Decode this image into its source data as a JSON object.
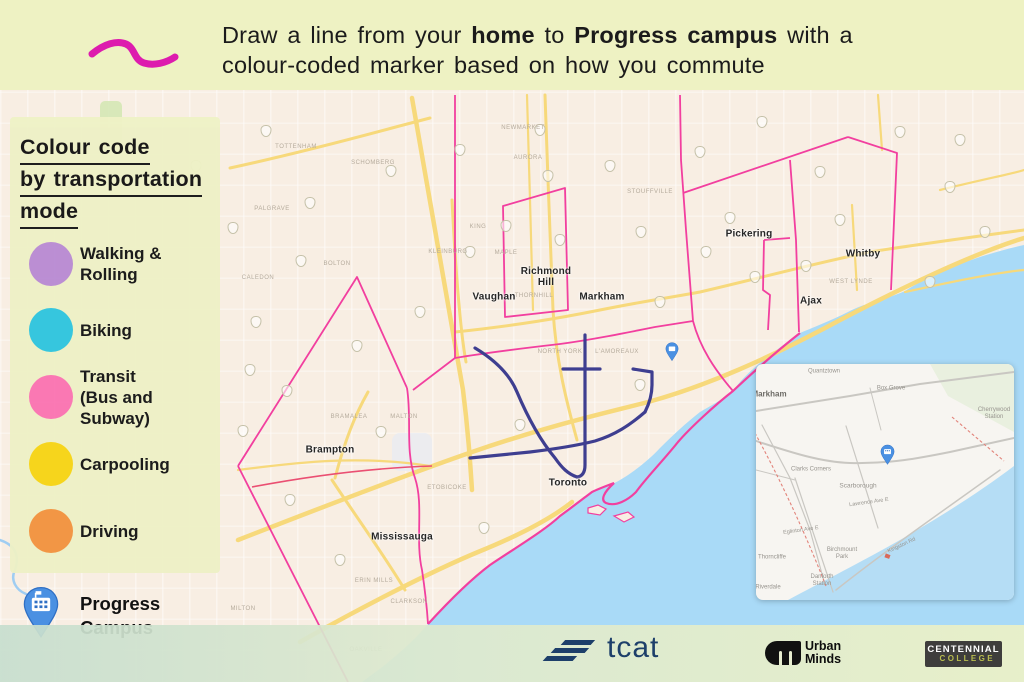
{
  "colors": {
    "header_bg": "#eef2c3",
    "accent_squiggle": "#dd1cae",
    "panel_bg": "#eef1c6",
    "land": "#f8eee3",
    "water": "#a9daf7",
    "highway": "#f7d97b",
    "boundary_pink": "#f23f9f",
    "boundary_red": "#ea4f72",
    "subway_navy": "#3e3e90",
    "pin_blue": "#4a90e2",
    "pin_dark": "#2f6fc4",
    "tcat_navy": "#1d3f6a",
    "um_black": "#111111",
    "centennial_bg": "#3e3d3c",
    "centennial_college": "#b9bd4f",
    "text_dark": "#1b1b1b"
  },
  "header": {
    "segments": [
      {
        "text": "Draw a line from your ",
        "bold": false
      },
      {
        "text": "home",
        "bold": true
      },
      {
        "text": " to ",
        "bold": false
      },
      {
        "text": "Progress campus",
        "bold": true
      },
      {
        "text": " with a",
        "bold": false
      }
    ],
    "line2": "colour-coded marker based on how you commute"
  },
  "legend": {
    "title_lines": [
      "Colour code",
      "by transportation",
      "mode"
    ],
    "items": [
      {
        "label_lines": [
          "Walking &",
          "Rolling"
        ],
        "color": "#b98bd3"
      },
      {
        "label_lines": [
          "Biking"
        ],
        "color": "#2fc5de"
      },
      {
        "label_lines": [
          "Transit",
          "(Bus and Subway)"
        ],
        "color": "#fb74b2"
      },
      {
        "label_lines": [
          "Carpooling"
        ],
        "color": "#f6d414"
      },
      {
        "label_lines": [
          "Driving"
        ],
        "color": "#f2933f"
      }
    ],
    "campus": {
      "label_lines": [
        "Progress",
        "Campus"
      ]
    }
  },
  "map": {
    "cities": [
      {
        "lines": [
          "Brampton"
        ],
        "x": 330,
        "y": 450
      },
      {
        "lines": [
          "Mississauga"
        ],
        "x": 402,
        "y": 537
      },
      {
        "lines": [
          "Vaughan"
        ],
        "x": 494,
        "y": 297
      },
      {
        "lines": [
          "Richmond",
          "Hill"
        ],
        "x": 546,
        "y": 277
      },
      {
        "lines": [
          "Markham"
        ],
        "x": 602,
        "y": 297
      },
      {
        "lines": [
          "Toronto"
        ],
        "x": 568,
        "y": 483
      },
      {
        "lines": [
          "Pickering"
        ],
        "x": 749,
        "y": 234
      },
      {
        "lines": [
          "Ajax"
        ],
        "x": 811,
        "y": 301
      },
      {
        "lines": [
          "Whitby"
        ],
        "x": 863,
        "y": 254
      }
    ],
    "faint_labels": [
      {
        "text": "TOTTENHAM",
        "x": 296,
        "y": 147
      },
      {
        "text": "SCHOMBERG",
        "x": 373,
        "y": 163
      },
      {
        "text": "NEWMARKET",
        "x": 523,
        "y": 128
      },
      {
        "text": "AURORA",
        "x": 528,
        "y": 158
      },
      {
        "text": "KING",
        "x": 478,
        "y": 227
      },
      {
        "text": "PALGRAVE",
        "x": 272,
        "y": 209
      },
      {
        "text": "BOLTON",
        "x": 337,
        "y": 264
      },
      {
        "text": "CALEDON",
        "x": 258,
        "y": 278
      },
      {
        "text": "KLEINBURG",
        "x": 448,
        "y": 252
      },
      {
        "text": "MAPLE",
        "x": 506,
        "y": 253
      },
      {
        "text": "THORNHILL",
        "x": 534,
        "y": 296
      },
      {
        "text": "MALTON",
        "x": 404,
        "y": 417
      },
      {
        "text": "BRAMALEA",
        "x": 349,
        "y": 417
      },
      {
        "text": "ERIN MILLS",
        "x": 374,
        "y": 581
      },
      {
        "text": "CLARKSON",
        "x": 409,
        "y": 602
      },
      {
        "text": "ETOBICOKE",
        "x": 447,
        "y": 488
      },
      {
        "text": "NORTH YORK",
        "x": 560,
        "y": 352
      },
      {
        "text": "L'AMOREAUX",
        "x": 617,
        "y": 352
      },
      {
        "text": "STOUFFVILLE",
        "x": 650,
        "y": 192
      },
      {
        "text": "WEST LYNDE",
        "x": 851,
        "y": 282
      },
      {
        "text": "OAKVILLE",
        "x": 366,
        "y": 650
      },
      {
        "text": "MILTON",
        "x": 243,
        "y": 609
      }
    ],
    "shield_positions": [
      [
        266,
        131
      ],
      [
        196,
        166
      ],
      [
        233,
        228
      ],
      [
        310,
        203
      ],
      [
        391,
        171
      ],
      [
        301,
        261
      ],
      [
        256,
        322
      ],
      [
        287,
        391
      ],
      [
        243,
        431
      ],
      [
        357,
        346
      ],
      [
        420,
        312
      ],
      [
        381,
        432
      ],
      [
        470,
        252
      ],
      [
        506,
        226
      ],
      [
        548,
        176
      ],
      [
        610,
        166
      ],
      [
        641,
        232
      ],
      [
        700,
        152
      ],
      [
        762,
        122
      ],
      [
        820,
        172
      ],
      [
        900,
        132
      ],
      [
        950,
        187
      ],
      [
        985,
        232
      ],
      [
        930,
        282
      ],
      [
        706,
        252
      ],
      [
        660,
        302
      ],
      [
        755,
        277
      ],
      [
        806,
        266
      ],
      [
        730,
        218
      ],
      [
        560,
        240
      ],
      [
        640,
        385
      ],
      [
        520,
        425
      ],
      [
        484,
        528
      ],
      [
        340,
        560
      ],
      [
        290,
        500
      ],
      [
        250,
        370
      ],
      [
        540,
        130
      ],
      [
        460,
        150
      ],
      [
        840,
        220
      ],
      [
        960,
        140
      ]
    ]
  },
  "inset": {
    "labels": [
      {
        "text": "Markham",
        "x": 769,
        "y": 394,
        "size": 8,
        "bold": true,
        "color": "#6d6b66"
      },
      {
        "text": "Quantztown",
        "x": 824,
        "y": 372,
        "size": 6
      },
      {
        "text": "Box Grove",
        "x": 891,
        "y": 389,
        "size": 6
      },
      {
        "text": "Cherrywood\nStation",
        "x": 994,
        "y": 414,
        "size": 6
      },
      {
        "text": "Clarks Corners",
        "x": 811,
        "y": 470,
        "size": 6
      },
      {
        "text": "Scarborough",
        "x": 858,
        "y": 486,
        "size": 6.5
      },
      {
        "text": "Lawrence Ave E",
        "x": 869,
        "y": 503,
        "size": 5.5,
        "rot": -8
      },
      {
        "text": "Eglinton Ave E",
        "x": 801,
        "y": 531,
        "size": 5.5,
        "rot": -8
      },
      {
        "text": "Birchmount\nPark",
        "x": 842,
        "y": 554,
        "size": 6
      },
      {
        "text": "Thorncliffe",
        "x": 772,
        "y": 558,
        "size": 6
      },
      {
        "text": "Danforth\nStation",
        "x": 822,
        "y": 581,
        "size": 6
      },
      {
        "text": "Riverdale",
        "x": 768,
        "y": 588,
        "size": 6
      },
      {
        "text": "Kingston Rd",
        "x": 902,
        "y": 546,
        "size": 5.5,
        "rot": -25
      }
    ]
  },
  "footer": {
    "tcat_label": "tcat",
    "urban_minds_lines": [
      "Urban",
      "Minds"
    ],
    "centennial_lines": [
      "CENTENNIAL",
      "COLLEGE"
    ]
  }
}
